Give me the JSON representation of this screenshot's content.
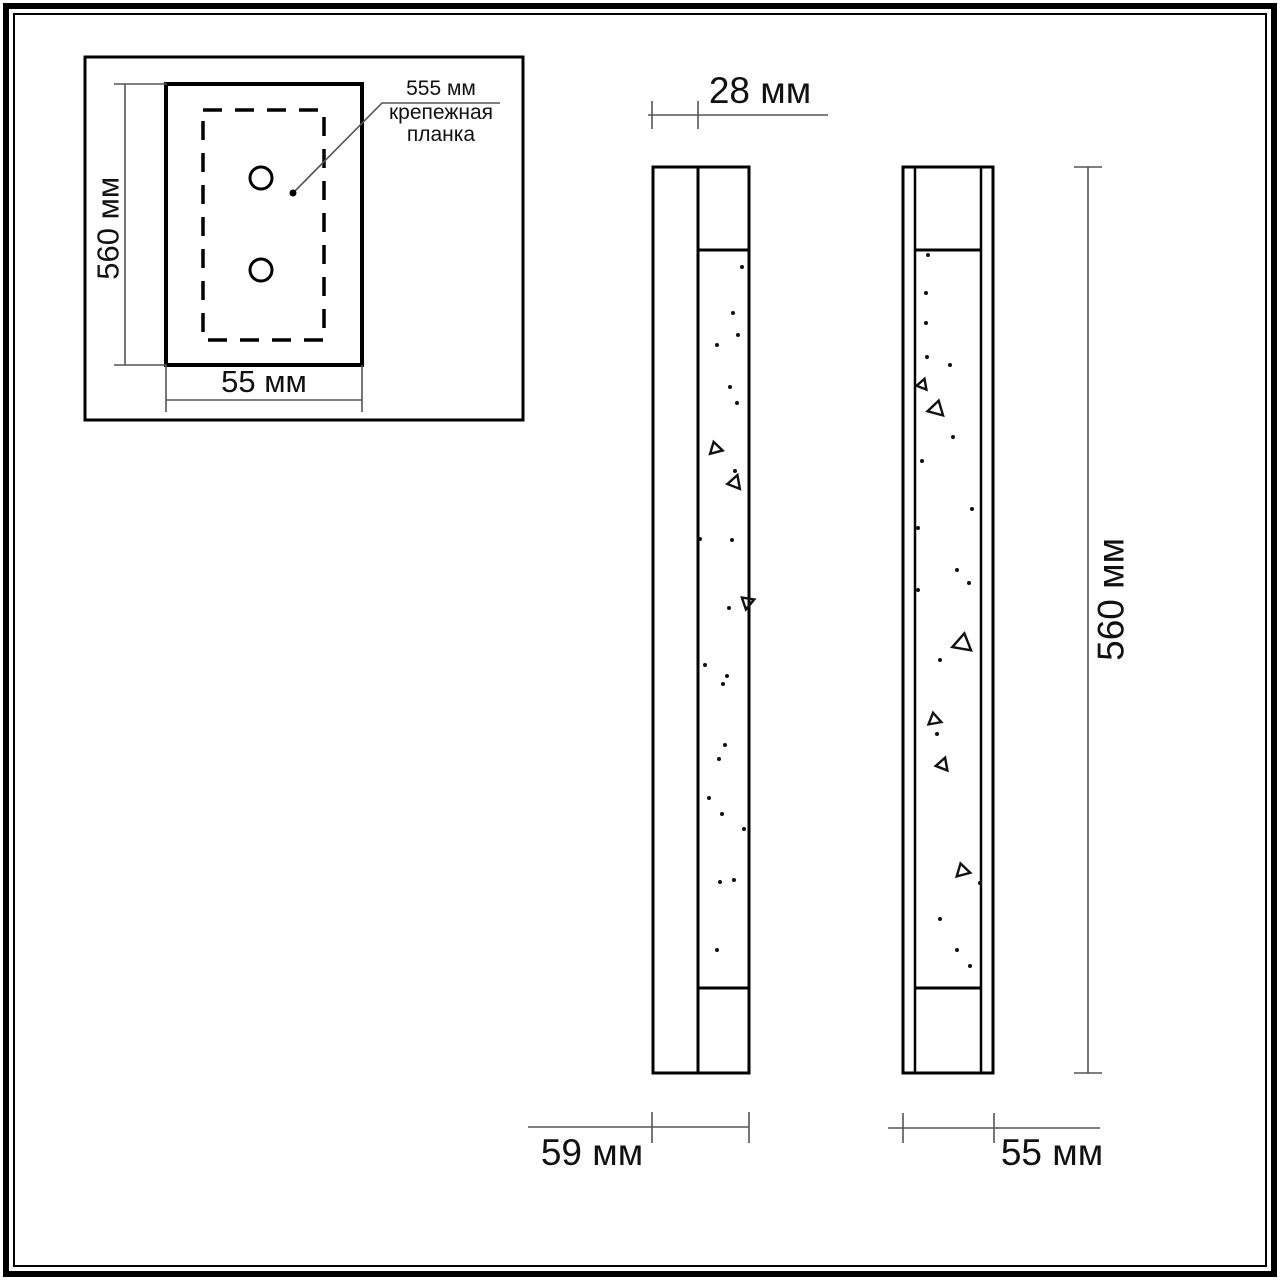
{
  "colors": {
    "line": "#000000",
    "dimension_line": "#555555",
    "background": "#ffffff",
    "text": "#111111"
  },
  "inset": {
    "height_label": "560 мм",
    "width_label": "55 мм",
    "plate_length_label": "555 мм",
    "plate_caption": "крепежная\nпланка"
  },
  "side_view": {
    "depth_label": "28 мм",
    "width_label": "59 мм"
  },
  "front_view": {
    "height_label": "560 мм",
    "width_label": "55 мм"
  }
}
